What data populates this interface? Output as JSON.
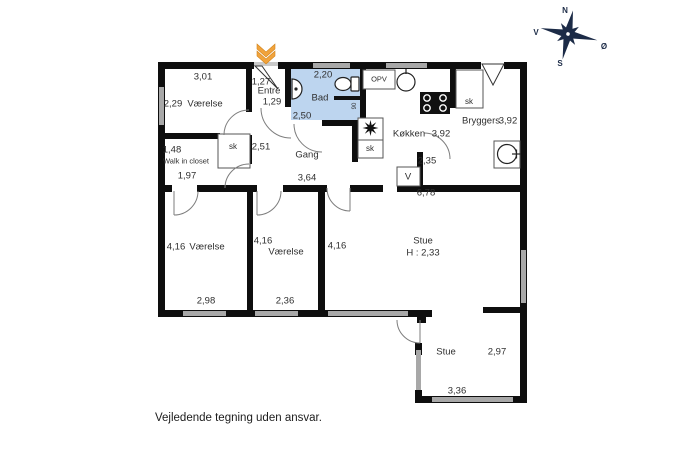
{
  "disclaimer": "Vejledende tegning uden ansvar.",
  "compass": {
    "north": "N",
    "west": "V",
    "east": "Ø",
    "south": "S"
  },
  "colors": {
    "wall": "#0e0e0e",
    "window": "#a8a8a8",
    "bath_fill": "#bdd5ef",
    "arrow": "#f1a33c",
    "compass": "#1c2b47",
    "label": "#2f2f2f"
  },
  "rooms": {
    "bedroom_nw": {
      "name": "Værelse",
      "dim_top": "3,01",
      "dim_left": "2,29"
    },
    "entre": {
      "name": "Entré",
      "dim_top": "1,27",
      "dim_bottom": "1,29"
    },
    "bath": {
      "name": "Bad",
      "dim_top": "2,20",
      "dim_left": "2,50",
      "dim_niche": "90"
    },
    "kitchen": {
      "name": "Køkken",
      "dim": "3,92",
      "appliance": "OPV",
      "closet": "sk"
    },
    "utility": {
      "name": "Bryggers",
      "dim": "3,92",
      "dim_width": "2,35",
      "closet": "sk",
      "washer": "V"
    },
    "walk_in_closet": {
      "name": "Walk in closet",
      "dim_top": "1,48",
      "dim_bottom": "1,97"
    },
    "hall": {
      "name": "Gang",
      "closet": "sk",
      "dim_width": "2,51",
      "dim_length": "3,64"
    },
    "bedroom_sw": {
      "name": "Værelse",
      "dim_left": "4,16",
      "dim_bottom": "2,98"
    },
    "bedroom_s": {
      "name": "Værelse",
      "dim_left": "4,16",
      "dim_bottom": "2,36"
    },
    "living": {
      "name": "Stue",
      "ceiling_height": "H : 2,33",
      "dim_top": "6,78",
      "dim_left": "4,16"
    },
    "living_ext": {
      "name": "Stue",
      "dim_right": "2,97",
      "dim_bottom": "3,36"
    }
  }
}
